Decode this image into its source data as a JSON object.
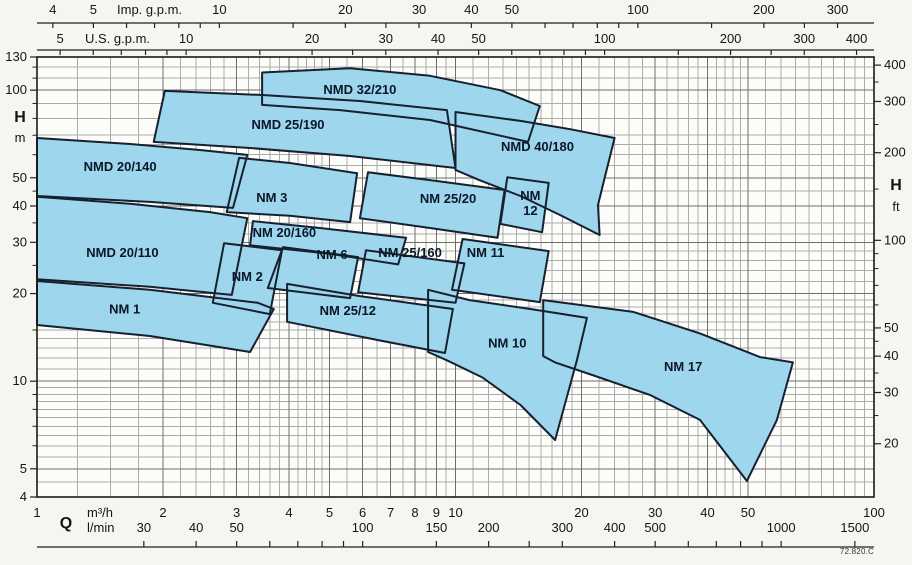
{
  "meta": {
    "drawing_code": "72.820.C"
  },
  "colors": {
    "page_bg": "#f6f5f0",
    "plot_bg": "#fcfcf9",
    "region_fill": "#9ed6ee",
    "region_stroke": "#16202e",
    "grid_major": "#6e6e6e",
    "grid_minor": "#ababab",
    "frame": "#1a1a1a",
    "text": "#141414",
    "label_text": "#0b1726"
  },
  "chart_data": {
    "type": "area",
    "title": "Pump selection chart NM / NMD series",
    "x_axis_symbol": "Q",
    "x_units_bottom": [
      "m³/h",
      "l/min"
    ],
    "x_units_top": [
      "Imp. g.p.m.",
      "U.S. g.p.m."
    ],
    "y_axis_symbol": "H",
    "y_units": [
      "m",
      "ft"
    ],
    "x_range_m3h": [
      1,
      100
    ],
    "y_range_m": [
      4,
      130
    ],
    "scale": "log-log",
    "conversions": {
      "imp_gpm_per_m3h": 3.6662,
      "us_gpm_per_m3h": 4.4029,
      "lmin_per_m3h": 16.6667,
      "ft_per_m": 3.2808
    },
    "grid": {
      "v_major_m3h": [
        2,
        3,
        4,
        5,
        6,
        7,
        8,
        9,
        10,
        20,
        30,
        40,
        50
      ],
      "v_minor_m3h": [
        1.25,
        1.5,
        1.75,
        2.2,
        2.4,
        2.6,
        2.8,
        3.2,
        3.4,
        3.6,
        3.8,
        4.2,
        4.4,
        4.6,
        4.8,
        5.5,
        6.5,
        7.5,
        8.5,
        9.5,
        11,
        12,
        13,
        14,
        15,
        16,
        17,
        18,
        19,
        22,
        24,
        26,
        28,
        32,
        34,
        36,
        38,
        42,
        44,
        46,
        48,
        55,
        60,
        65,
        70,
        75,
        80,
        85,
        90,
        95
      ],
      "h_major_m": [
        5,
        10,
        20,
        30,
        40,
        50,
        100
      ],
      "h_minor_m": [
        4.5,
        5.5,
        6,
        6.5,
        7,
        7.5,
        8,
        8.5,
        9,
        9.5,
        11,
        12,
        13,
        14,
        15,
        16,
        17,
        18,
        19,
        22,
        24,
        26,
        28,
        32,
        35,
        45,
        55,
        60,
        65,
        70,
        80,
        90,
        110,
        120
      ]
    },
    "axes": {
      "top_imp": {
        "title": "Imp. g.p.m.",
        "ticks": [
          4,
          5,
          6,
          7,
          8,
          9,
          10,
          15,
          20,
          25,
          30,
          40,
          50,
          60,
          70,
          80,
          90,
          100,
          150,
          200,
          250,
          300
        ],
        "labels": [
          4,
          5,
          10,
          20,
          30,
          40,
          50,
          100,
          200,
          300
        ]
      },
      "top_us": {
        "title": "U.S. g.p.m.",
        "ticks": [
          5,
          6,
          7,
          8,
          9,
          10,
          15,
          20,
          25,
          30,
          40,
          50,
          60,
          70,
          80,
          90,
          100,
          150,
          200,
          250,
          300,
          400
        ],
        "labels": [
          5,
          10,
          20,
          30,
          40,
          50,
          100,
          200,
          300,
          400
        ]
      },
      "left_m": {
        "labels": [
          130,
          100,
          50,
          40,
          30,
          20,
          10,
          5,
          4
        ],
        "minor_ticks": [
          6,
          7,
          8,
          9,
          15,
          25,
          35,
          45,
          60,
          70,
          80,
          90,
          110,
          120
        ]
      },
      "right_ft": {
        "labels": [
          400,
          300,
          200,
          100,
          50,
          40,
          30,
          20
        ],
        "minor_ticks": [
          25,
          35,
          45,
          60,
          70,
          80,
          90,
          150,
          250,
          350
        ]
      },
      "bottom_m3h": {
        "labels": [
          1,
          2,
          3,
          4,
          5,
          6,
          7,
          8,
          9,
          10,
          20,
          30,
          40,
          50,
          100
        ]
      },
      "bottom_lmin": {
        "labels": [
          30,
          40,
          50,
          100,
          150,
          200,
          300,
          400,
          500,
          1000,
          1500
        ],
        "minor_ticks": [
          60,
          70,
          80,
          90,
          250,
          600,
          700,
          800,
          900
        ]
      }
    },
    "regions": [
      {
        "name": "NMD 20/140",
        "label_at": {
          "q": 1.58,
          "h": 54.4
        },
        "points": [
          [
            1.0,
            68.5
          ],
          [
            1.67,
            65.3
          ],
          [
            2.45,
            62.3
          ],
          [
            3.18,
            59.9
          ],
          [
            2.94,
            39.4
          ],
          [
            1.86,
            41.3
          ],
          [
            1.0,
            43.3
          ]
        ]
      },
      {
        "name": "NMD 25/190",
        "label_at": {
          "q": 3.98,
          "h": 75.8
        },
        "points": [
          [
            2.02,
            99.4
          ],
          [
            3.41,
            96.3
          ],
          [
            5.91,
            91.8
          ],
          [
            9.54,
            85.4
          ],
          [
            10.0,
            54.0
          ],
          [
            5.6,
            59.4
          ],
          [
            3.23,
            63.3
          ],
          [
            1.9,
            66.4
          ]
        ]
      },
      {
        "name": "NMD 32/210",
        "label_at": {
          "q": 5.91,
          "h": 100
        },
        "points": [
          [
            3.45,
            115
          ],
          [
            5.6,
            119
          ],
          [
            8.69,
            112
          ],
          [
            12.8,
            100
          ],
          [
            15.9,
            88.2
          ],
          [
            14.9,
            66.4
          ],
          [
            8.69,
            79.0
          ],
          [
            5.3,
            85.4
          ],
          [
            3.45,
            89.0
          ]
        ]
      },
      {
        "name": "NMD 40/180",
        "label_at": {
          "q": 15.7,
          "h": 63.8
        },
        "points": [
          [
            10.0,
            84.1
          ],
          [
            14.3,
            78.4
          ],
          [
            18.8,
            73.4
          ],
          [
            24.0,
            68.5
          ],
          [
            22.8,
            51.0
          ],
          [
            21.9,
            40.3
          ],
          [
            22.1,
            31.8
          ],
          [
            17.8,
            37.2
          ],
          [
            14.3,
            43.3
          ],
          [
            11.4,
            49.1
          ],
          [
            10.0,
            53.2
          ]
        ]
      },
      {
        "name": "NMD 20/110",
        "label_at": {
          "q": 1.6,
          "h": 27.6
        },
        "points": [
          [
            1.0,
            43.0
          ],
          [
            1.67,
            40.7
          ],
          [
            2.59,
            38.1
          ],
          [
            3.18,
            36.3
          ],
          [
            2.92,
            19.8
          ],
          [
            1.86,
            21.1
          ],
          [
            1.0,
            22.4
          ]
        ]
      },
      {
        "name": "NM 3",
        "label_at": {
          "q": 3.64,
          "h": 42.6
        },
        "points": [
          [
            3.04,
            58.5
          ],
          [
            4.02,
            56.2
          ],
          [
            5.82,
            51.8
          ],
          [
            5.6,
            35.2
          ],
          [
            4.02,
            37.0
          ],
          [
            2.84,
            38.1
          ]
        ]
      },
      {
        "name": "NM 25/20",
        "label_at": {
          "q": 9.6,
          "h": 42.3
        },
        "points": [
          [
            6.18,
            52.2
          ],
          [
            8.69,
            49.1
          ],
          [
            13.1,
            45.4
          ],
          [
            12.6,
            31.1
          ],
          [
            8.69,
            33.6
          ],
          [
            5.91,
            36.3
          ]
        ]
      },
      {
        "name": "NM 12",
        "label_at": {
          "q": 15.1,
          "h": 43.3
        },
        "label_lines": [
          "NM",
          "12"
        ],
        "points": [
          [
            13.3,
            50.2
          ],
          [
            16.7,
            48.0
          ],
          [
            16.1,
            32.5
          ],
          [
            12.8,
            34.7
          ]
        ]
      },
      {
        "name": "NM 20/160",
        "label_at": {
          "q": 3.9,
          "h": 32.3
        },
        "points": [
          [
            3.28,
            35.5
          ],
          [
            4.74,
            33.6
          ],
          [
            7.62,
            31.1
          ],
          [
            7.29,
            25.2
          ],
          [
            5.01,
            27.4
          ],
          [
            3.23,
            29.3
          ]
        ]
      },
      {
        "name": "NM 1",
        "label_at": {
          "q": 1.62,
          "h": 17.6
        },
        "points": [
          [
            1.0,
            22.1
          ],
          [
            1.86,
            20.6
          ],
          [
            3.37,
            18.6
          ],
          [
            3.68,
            17.7
          ],
          [
            3.23,
            12.6
          ],
          [
            1.86,
            14.3
          ],
          [
            1.0,
            15.6
          ]
        ]
      },
      {
        "name": "NM 2",
        "label_at": {
          "q": 3.18,
          "h": 22.8
        },
        "points": [
          [
            2.8,
            29.8
          ],
          [
            3.85,
            28.2
          ],
          [
            3.6,
            17.0
          ],
          [
            2.63,
            18.6
          ]
        ]
      },
      {
        "name": "NM 6",
        "label_at": {
          "q": 5.07,
          "h": 27.1
        },
        "points": [
          [
            3.87,
            28.9
          ],
          [
            5.85,
            26.7
          ],
          [
            5.6,
            19.3
          ],
          [
            3.56,
            20.9
          ]
        ]
      },
      {
        "name": "NM 25/160",
        "label_at": {
          "q": 7.79,
          "h": 27.6
        },
        "points": [
          [
            6.11,
            28.2
          ],
          [
            10.5,
            25.4
          ],
          [
            10.0,
            18.6
          ],
          [
            5.85,
            20.2
          ]
        ]
      },
      {
        "name": "NM 11",
        "label_at": {
          "q": 11.8,
          "h": 27.6
        },
        "points": [
          [
            10.4,
            30.8
          ],
          [
            16.7,
            28.0
          ],
          [
            15.9,
            18.7
          ],
          [
            9.81,
            20.6
          ]
        ]
      },
      {
        "name": "NM 25/12",
        "label_at": {
          "q": 5.53,
          "h": 17.4
        },
        "points": [
          [
            3.96,
            21.6
          ],
          [
            5.91,
            19.6
          ],
          [
            9.86,
            17.7
          ],
          [
            9.44,
            12.5
          ],
          [
            6.6,
            13.8
          ],
          [
            3.96,
            16.0
          ]
        ]
      },
      {
        "name": "NM 10",
        "label_at": {
          "q": 13.3,
          "h": 13.5
        },
        "points": [
          [
            8.6,
            20.6
          ],
          [
            10.8,
            19.0
          ],
          [
            15.1,
            17.7
          ],
          [
            20.6,
            16.5
          ],
          [
            19.5,
            11.8
          ],
          [
            17.3,
            6.28
          ],
          [
            14.3,
            8.28
          ],
          [
            11.6,
            10.3
          ],
          [
            9.54,
            11.8
          ],
          [
            8.6,
            12.6
          ]
        ]
      },
      {
        "name": "NM 17",
        "label_at": {
          "q": 35.0,
          "h": 11.2
        },
        "points": [
          [
            16.2,
            19.0
          ],
          [
            26.6,
            17.3
          ],
          [
            38.4,
            14.6
          ],
          [
            53.4,
            12.1
          ],
          [
            64.0,
            11.6
          ],
          [
            58.6,
            7.36
          ],
          [
            49.7,
            4.54
          ],
          [
            38.4,
            7.36
          ],
          [
            29.2,
            8.96
          ],
          [
            22.1,
            10.3
          ],
          [
            17.3,
            11.6
          ],
          [
            16.2,
            12.2
          ]
        ]
      }
    ]
  }
}
